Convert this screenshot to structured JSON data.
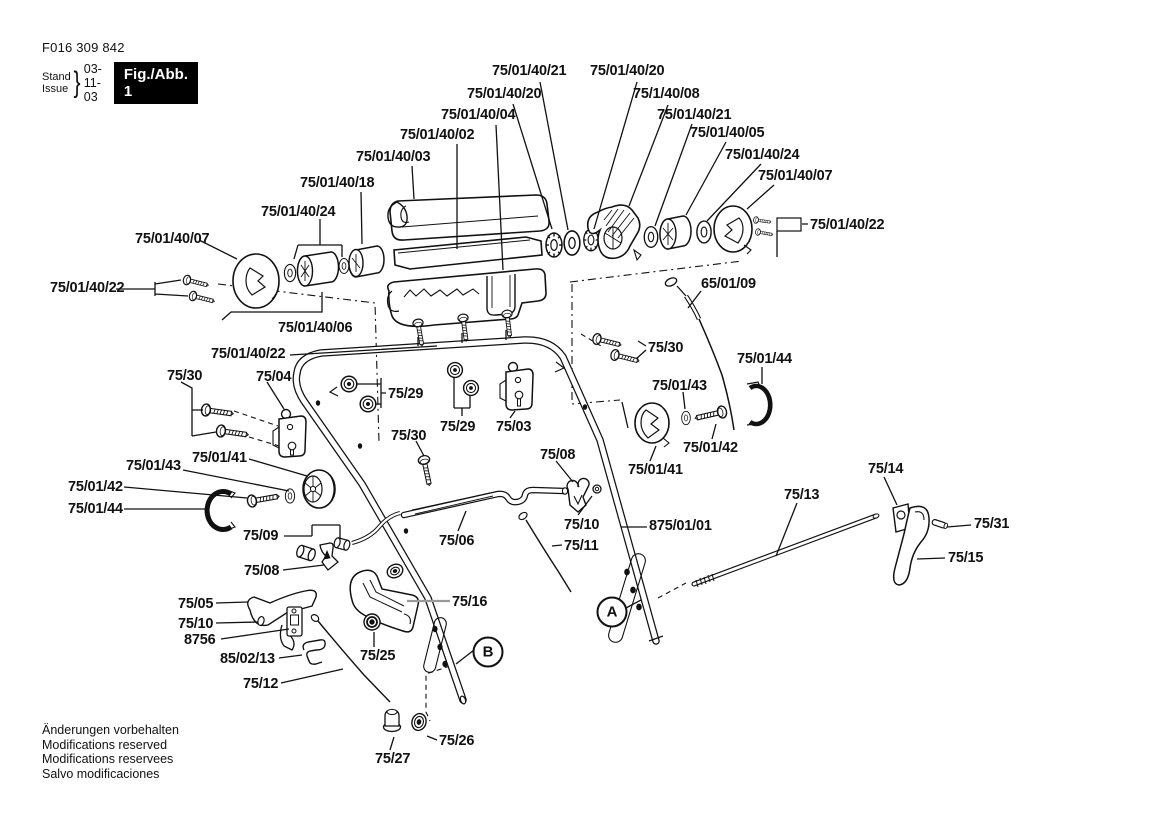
{
  "header": {
    "part_number": "F016 309 842",
    "stand_label": "Stand",
    "issue_label": "Issue",
    "brace": "}",
    "date": "03-11-03",
    "figure_label": "Fig./Abb. 1"
  },
  "footer": {
    "lines": [
      "Änderungen vorbehalten",
      "Modifications reserved",
      "Modifications reservees",
      "Salvo modificaciones"
    ]
  },
  "markers": [
    {
      "letter": "A",
      "x": 612,
      "y": 612
    },
    {
      "letter": "B",
      "x": 488,
      "y": 652
    }
  ],
  "labels": [
    {
      "text": "75/01/40/21",
      "x": 492,
      "y": 63
    },
    {
      "text": "75/01/40/20",
      "x": 590,
      "y": 63
    },
    {
      "text": "75/01/40/20",
      "x": 467,
      "y": 86
    },
    {
      "text": "75/1/40/08",
      "x": 633,
      "y": 86
    },
    {
      "text": "75/01/40/04",
      "x": 441,
      "y": 107
    },
    {
      "text": "75/01/40/21",
      "x": 657,
      "y": 107
    },
    {
      "text": "75/01/40/02",
      "x": 400,
      "y": 127
    },
    {
      "text": "75/01/40/05",
      "x": 690,
      "y": 125
    },
    {
      "text": "75/01/40/03",
      "x": 356,
      "y": 149
    },
    {
      "text": "75/01/40/24",
      "x": 725,
      "y": 147
    },
    {
      "text": "75/01/40/18",
      "x": 300,
      "y": 175
    },
    {
      "text": "75/01/40/07",
      "x": 758,
      "y": 168
    },
    {
      "text": "75/01/40/24",
      "x": 261,
      "y": 204
    },
    {
      "text": "75/01/40/22",
      "x": 810,
      "y": 217
    },
    {
      "text": "75/01/40/07",
      "x": 135,
      "y": 231
    },
    {
      "text": "75/01/40/22",
      "x": 50,
      "y": 280
    },
    {
      "text": "65/01/09",
      "x": 701,
      "y": 276
    },
    {
      "text": "75/01/40/06",
      "x": 278,
      "y": 320
    },
    {
      "text": "75/01/40/22",
      "x": 211,
      "y": 346
    },
    {
      "text": "75/30",
      "x": 648,
      "y": 340
    },
    {
      "text": "75/01/44",
      "x": 737,
      "y": 351
    },
    {
      "text": "75/30",
      "x": 167,
      "y": 368
    },
    {
      "text": "75/04",
      "x": 256,
      "y": 369
    },
    {
      "text": "75/29",
      "x": 388,
      "y": 386
    },
    {
      "text": "75/01/43",
      "x": 652,
      "y": 378
    },
    {
      "text": "75/29",
      "x": 440,
      "y": 419
    },
    {
      "text": "75/03",
      "x": 496,
      "y": 419
    },
    {
      "text": "75/30",
      "x": 391,
      "y": 428
    },
    {
      "text": "75/01/43",
      "x": 126,
      "y": 458
    },
    {
      "text": "75/01/41",
      "x": 192,
      "y": 450
    },
    {
      "text": "75/01/41",
      "x": 628,
      "y": 462
    },
    {
      "text": "75/01/42",
      "x": 683,
      "y": 440
    },
    {
      "text": "75/14",
      "x": 868,
      "y": 461
    },
    {
      "text": "75/08",
      "x": 540,
      "y": 447
    },
    {
      "text": "75/01/42",
      "x": 68,
      "y": 479
    },
    {
      "text": "75/01/44",
      "x": 68,
      "y": 501
    },
    {
      "text": "75/13",
      "x": 784,
      "y": 487
    },
    {
      "text": "75/09",
      "x": 243,
      "y": 528
    },
    {
      "text": "75/10",
      "x": 564,
      "y": 517
    },
    {
      "text": "875/01/01",
      "x": 649,
      "y": 518
    },
    {
      "text": "75/31",
      "x": 974,
      "y": 516
    },
    {
      "text": "75/06",
      "x": 439,
      "y": 533
    },
    {
      "text": "75/11",
      "x": 564,
      "y": 538
    },
    {
      "text": "75/15",
      "x": 948,
      "y": 550
    },
    {
      "text": "75/08",
      "x": 244,
      "y": 563
    },
    {
      "text": "75/05",
      "x": 178,
      "y": 596
    },
    {
      "text": "75/16",
      "x": 452,
      "y": 594
    },
    {
      "text": "75/10",
      "x": 178,
      "y": 616
    },
    {
      "text": "8756",
      "x": 184,
      "y": 632
    },
    {
      "text": "85/02/13",
      "x": 220,
      "y": 651
    },
    {
      "text": "75/25",
      "x": 360,
      "y": 648
    },
    {
      "text": "75/12",
      "x": 243,
      "y": 676
    },
    {
      "text": "75/26",
      "x": 439,
      "y": 733
    },
    {
      "text": "75/27",
      "x": 375,
      "y": 751
    }
  ]
}
